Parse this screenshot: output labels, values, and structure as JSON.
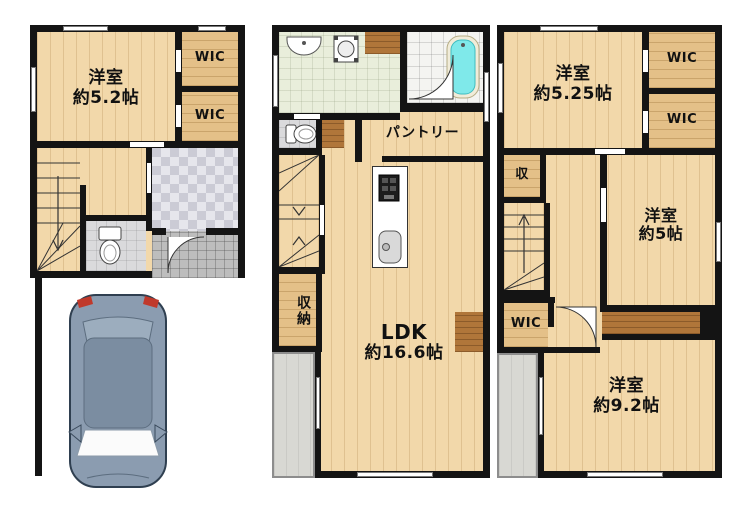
{
  "document_type": "floor-plan",
  "floor1": {
    "bedroom_name": "洋室",
    "bedroom_size": "約5.2帖",
    "wic_upper": "WIC",
    "wic_lower": "WIC"
  },
  "floor2": {
    "pantry": "パントリー",
    "storage": "収納",
    "ldk_name": "LDK",
    "ldk_size": "約16.6帖"
  },
  "floor3": {
    "bedroom_top_name": "洋室",
    "bedroom_top_size": "約5.25帖",
    "wic_upper": "WIC",
    "wic_lower": "WIC",
    "storage_small": "収",
    "bedroom_mid_name": "洋室",
    "bedroom_mid_size": "約5帖",
    "wic_hall": "WIC",
    "bedroom_big_name": "洋室",
    "bedroom_big_size": "約9.2帖"
  },
  "icons": [
    "stairs-icon",
    "toilet-icon",
    "sink-icon",
    "washing-machine-icon",
    "bathtub-icon",
    "stove-icon",
    "kitchen-sink-icon",
    "door-arc-icon",
    "car-icon",
    "window"
  ],
  "colors": {
    "wall": "#141414",
    "wood_floor": "#f2d8aa",
    "closet_wood": "#e4c088",
    "dark_closet": "#b0763a",
    "washroom_green": "#e9eedb",
    "bathtub_cyan": "#7fe9ea",
    "entrance_tile": "#cbcbd5",
    "porch_tile": "#bdbdbd",
    "balcony_gray": "#d8d8d3",
    "car_body": "#8b9cb0"
  }
}
